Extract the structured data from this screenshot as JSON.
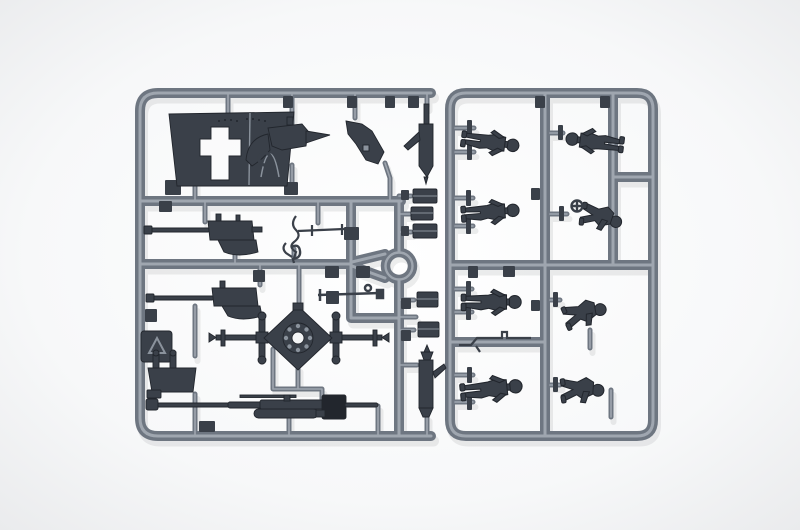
{
  "image": {
    "kind": "product photograph",
    "subject": "injection-molded plastic model kit sprue with artillery gun parts and eight soldier figures",
    "backdrop": "white studio background"
  },
  "palette": {
    "backdrop_center": "#ffffff",
    "backdrop_mid": "#f7f8f9",
    "backdrop_edge": "#e7e8ea",
    "rail_main": "#6e7681",
    "rail_highlight": "#a8afb8",
    "part_dark": "#3a4049",
    "part_edge": "#22262d",
    "part_detail": "#8a929c",
    "hole_light": "#f4f5f6",
    "shadow": "#20242a"
  },
  "left_frame": {
    "label": "weapon parts frame",
    "parts": [
      "gun shield with cross aperture",
      "machine gun on cradle",
      "mount bracket",
      "recoil cylinder (upper)",
      "machine gun (row 2)",
      "elevation crank linkage",
      "hook lever",
      "ammunition boxes x5",
      "machine gun (row 3)",
      "recycling mark plate",
      "fork bracket",
      "carriage cross-member with bolted hub",
      "traverse axle rod",
      "recoil cylinder (lower)",
      "gun barrel with muzzle brake and recuperator",
      "sprue gate blocks"
    ],
    "connector_ring": "circular runner ring at mid-right"
  },
  "right_frame": {
    "label": "figures frame",
    "figure_count": 8,
    "parts": [
      "reclining soldier",
      "soldier with outstretched arms",
      "standing soldier",
      "loader with handwheel",
      "standing gunner",
      "kneeling soldier",
      "walking soldier",
      "crouching loader",
      "ramrod tool"
    ]
  }
}
